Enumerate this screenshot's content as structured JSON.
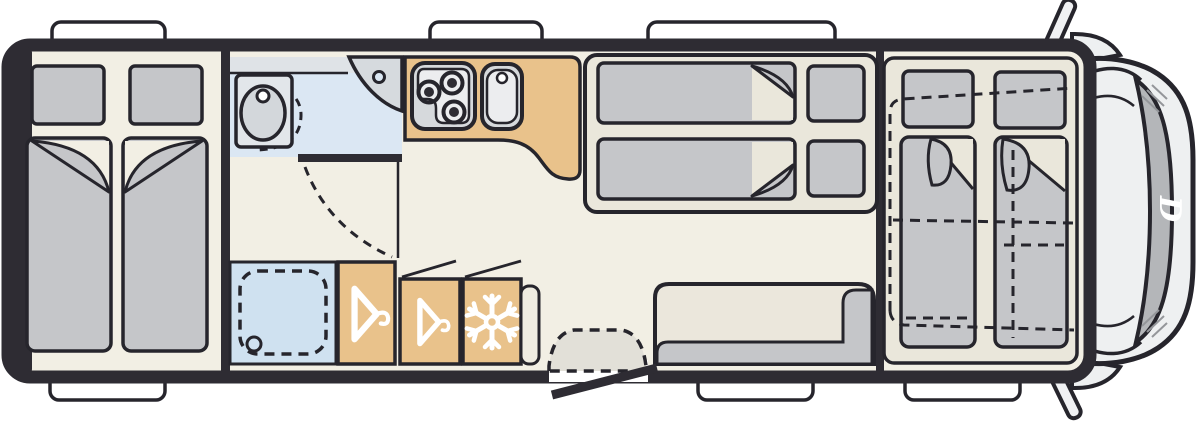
{
  "scene": {
    "type": "motorhome-floor-plan-top-view",
    "description": "Top-down floor plan of a motorhome: rear twin single beds, bathroom with toilet and corner washbasin, shower cubicle, two wardrobes with hanger symbols, refrigerator with snowflake symbol, kitchen block with 3-burner hob and sink, central drop-down double bed, dinette bench, entrance door with step, front drop-down bed over cab shown dashed, driver cab with windshield at right"
  },
  "cab": {
    "logo_letter": "D"
  },
  "icons": {
    "wardrobe_1": "hanger-icon",
    "wardrobe_2": "hanger-icon",
    "fridge": "snowflake-icon",
    "windshield_brand": "script-d-logo"
  },
  "colors": {
    "background": "#ffffff",
    "wall": "#2e2c33",
    "outline": "#26252c",
    "floor": "#f2efe4",
    "panel": "#eae7db",
    "upholstery": "#c5c6c9",
    "tan": "#e9c28b",
    "bathFloor": "#dbe7f3",
    "bathCounter": "#dfe3e7",
    "shower": "#cfe1f0",
    "applianceGrey": "#d6d9dc",
    "applianceInner": "#ecedef",
    "toiletBase": "#e2e6ea",
    "toiletBowl": "#d3d7db",
    "cornerSink": "#d6dade",
    "step": "#e2e0d8",
    "cab": "#eef0f1",
    "windshield": "#b4b6b9",
    "benchBack": "#ebe7dc",
    "cabinet": "#efece1",
    "mirror": "#f0f1f3",
    "white": "#ffffff",
    "streak": "#94969a"
  }
}
